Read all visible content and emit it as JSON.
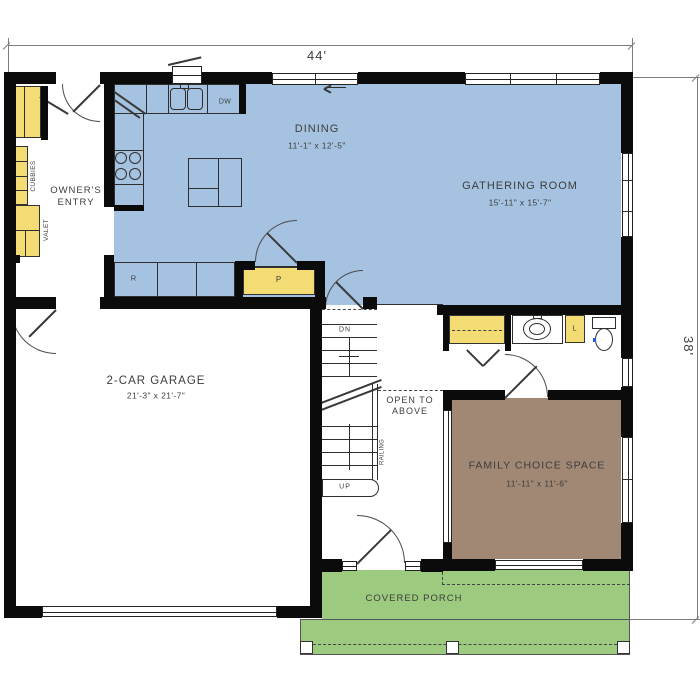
{
  "dimensions": {
    "width": "44'",
    "height": "38'"
  },
  "rooms": {
    "dining": {
      "name": "DINING",
      "size": "11'-1\" x 12'-5\""
    },
    "gathering": {
      "name": "GATHERING ROOM",
      "size": "15'-11\" x 15'-7\""
    },
    "owners_entry": {
      "name": "OWNER'S ENTRY"
    },
    "garage": {
      "name": "2-CAR GARAGE",
      "size": "21'-3\" x 21'-7\""
    },
    "family_choice": {
      "name": "FAMILY CHOICE SPACE",
      "size": "11'-11\" x 11'-6\""
    },
    "covered_porch": {
      "name": "COVERED PORCH"
    },
    "open_to_above": {
      "name": "OPEN TO ABOVE"
    }
  },
  "fixtures": {
    "dishwasher": "DW",
    "range": "R",
    "pantry": "P",
    "linen": "L",
    "stairs_down": "DN",
    "stairs_up": "UP",
    "cubbies": "CUBBIES",
    "valet": "VALET",
    "railing": "RAILING"
  },
  "colors": {
    "living_floor": "#a5c3e1",
    "family_floor": "#a18875",
    "porch_floor": "#9cca7e",
    "cabinet": "#f2dc73",
    "wall": "#0b0b0b"
  }
}
